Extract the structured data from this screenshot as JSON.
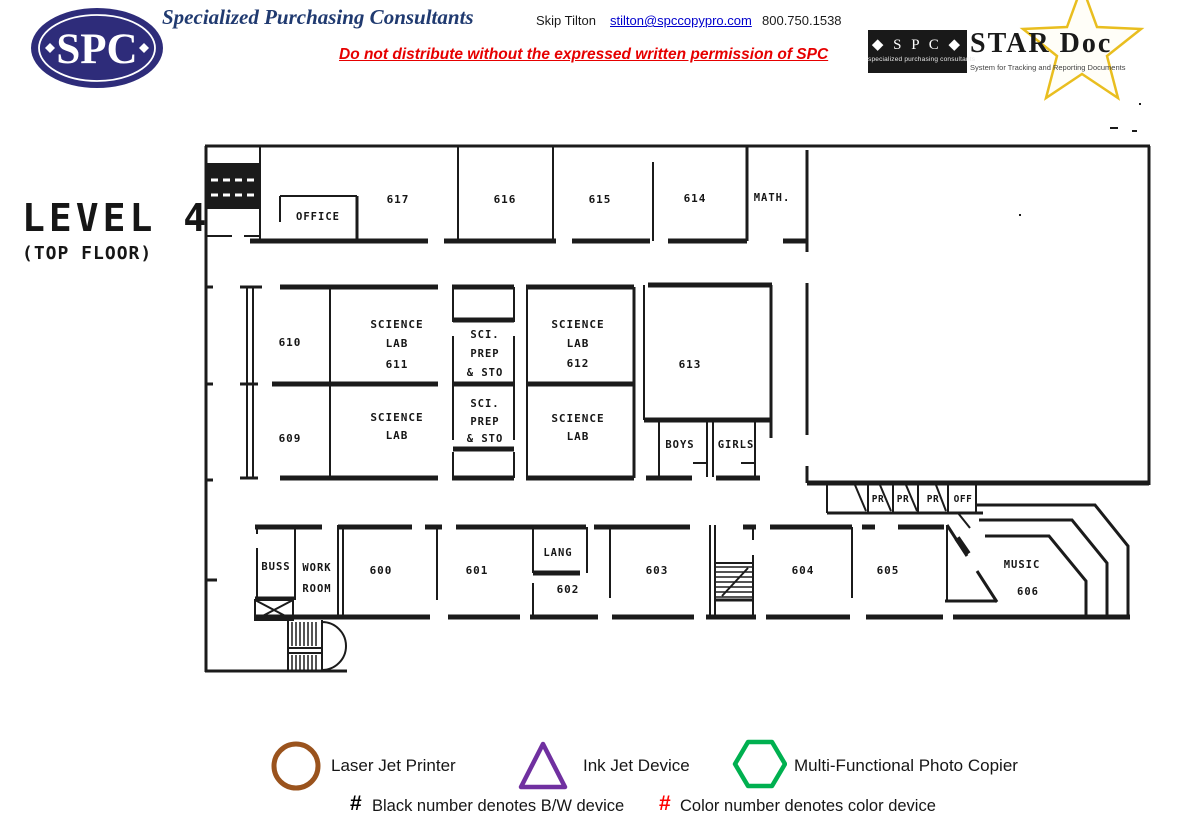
{
  "header": {
    "logo": {
      "text": "SPC"
    },
    "company_title": "Specialized Purchasing Consultants",
    "contact": {
      "name": "Skip Tilton",
      "email": "stilton@spccopypro.com",
      "phone": "800.750.1538"
    },
    "disclaimer": "Do not distribute without the expressed written permission of SPC",
    "stardoc_logo": {
      "box_title": "◆ S P C ◆",
      "box_subtitle": "specialized purchasing consultants",
      "title": "STAR Doc",
      "subtitle": "System for Tracking and Reporting Documents"
    }
  },
  "plan": {
    "title": "LEVEL 4",
    "subtitle": "(TOP FLOOR)",
    "rooms": {
      "office": {
        "label": "OFFICE"
      },
      "r617": {
        "label": "617"
      },
      "r616": {
        "label": "616"
      },
      "r615": {
        "label": "615"
      },
      "r614": {
        "label": "614"
      },
      "math": {
        "label": "MATH."
      },
      "r610": {
        "label": "610"
      },
      "r609": {
        "label": "609"
      },
      "science_lab_611": {
        "lines": [
          "SCIENCE",
          "LAB",
          "611"
        ]
      },
      "sci_prep_upper": {
        "lines": [
          "SCI.",
          "PREP",
          "& STO"
        ]
      },
      "science_lab_612": {
        "lines": [
          "SCIENCE",
          "LAB",
          "612"
        ]
      },
      "r613": {
        "label": "613"
      },
      "science_lab_sw": {
        "lines": [
          "SCIENCE",
          "LAB"
        ]
      },
      "sci_prep_lower": {
        "lines": [
          "SCI.",
          "PREP",
          "& STO"
        ]
      },
      "science_lab_se": {
        "lines": [
          "SCIENCE",
          "LAB"
        ]
      },
      "boys": {
        "label": "BOYS"
      },
      "girls": {
        "label": "GIRLS"
      },
      "pr1": {
        "label": "PR"
      },
      "pr2": {
        "label": "PR"
      },
      "pr3": {
        "label": "PR"
      },
      "off": {
        "label": "OFF"
      },
      "buss": {
        "label": "BUSS"
      },
      "work_room": {
        "lines": [
          "WORK",
          "ROOM"
        ]
      },
      "r600": {
        "label": "600"
      },
      "r601": {
        "label": "601"
      },
      "lang": {
        "label": "LANG"
      },
      "r602": {
        "label": "602"
      },
      "r603": {
        "label": "603"
      },
      "r604": {
        "label": "604"
      },
      "r605": {
        "label": "605"
      },
      "music": {
        "lines": [
          "MUSIC",
          "606"
        ]
      }
    }
  },
  "legend": {
    "items": [
      {
        "icon": "circle-icon",
        "color": "#9a531d",
        "label": "Laser Jet Printer"
      },
      {
        "icon": "triangle-icon",
        "color": "#7030a0",
        "label": "Ink Jet Device"
      },
      {
        "icon": "hexagon-icon",
        "color": "#00b050",
        "label": "Multi-Functional Photo Copier"
      }
    ],
    "notes": [
      {
        "symbol": "#",
        "color": "#000000",
        "label": "Black number denotes B/W device"
      },
      {
        "symbol": "#",
        "color": "#ff0000",
        "label": "Color number denotes color device"
      }
    ]
  }
}
